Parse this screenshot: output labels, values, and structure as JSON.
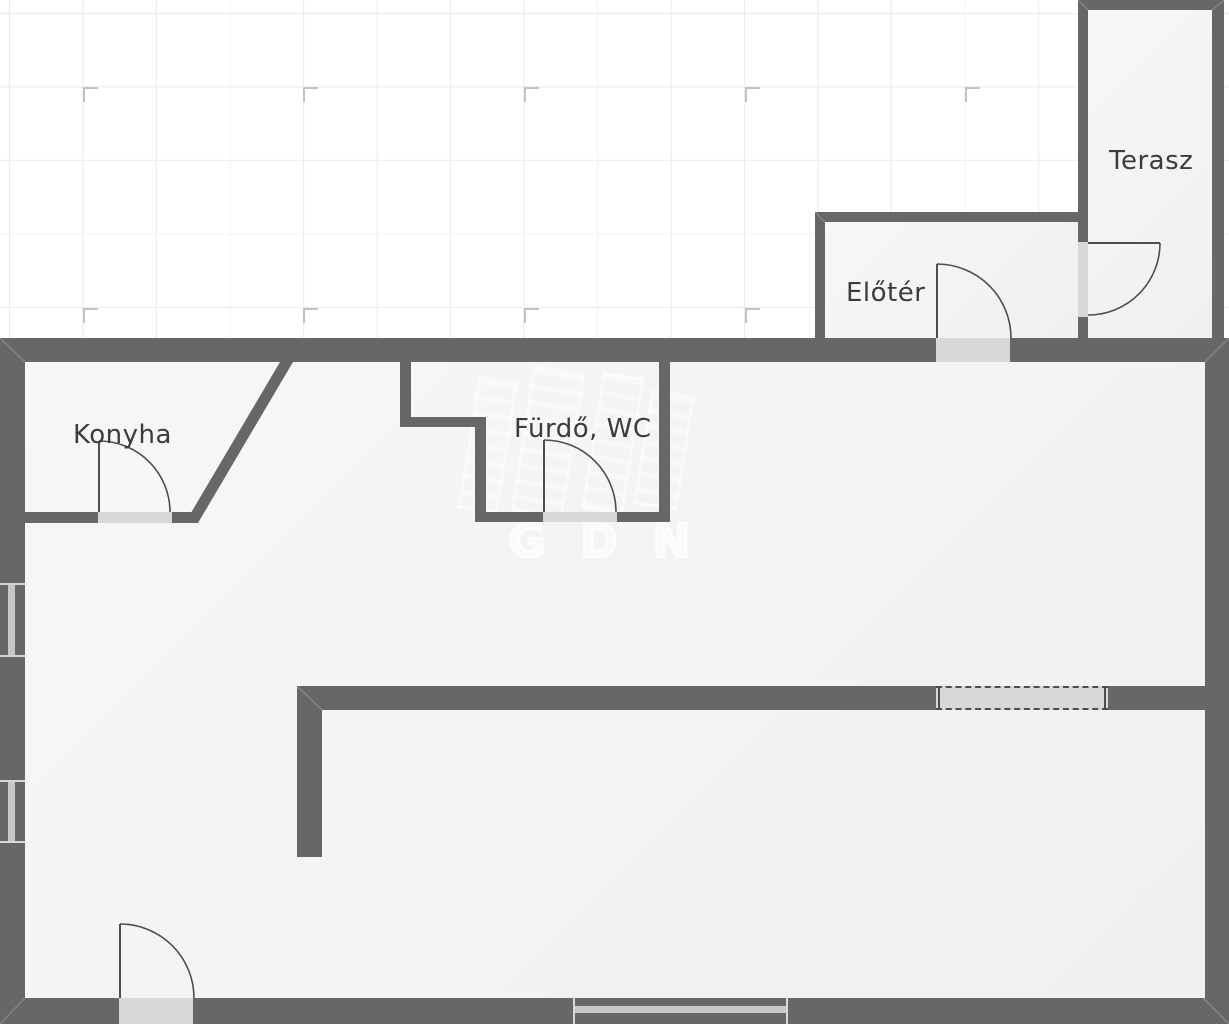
{
  "plan": {
    "rooms": [
      {
        "id": "terasz",
        "label": "Terasz"
      },
      {
        "id": "eloter",
        "label": "Előtér"
      },
      {
        "id": "konyha",
        "label": "Konyha"
      },
      {
        "id": "furdo_wc",
        "label": "Fürdő, WC"
      }
    ],
    "watermark": {
      "text": "GDN"
    },
    "colors": {
      "wall": "#676767",
      "floor_light": "#f7f7f7",
      "floor_dark": "#f0f0f1",
      "opening": "#d8d8d8",
      "glass": "#c7c7c7",
      "grid_line": "#ececec",
      "grid_mark": "#c2c2c2",
      "door_stroke": "#4d4d4d",
      "label": "#3c3c3c",
      "background": "#ffffff"
    }
  }
}
